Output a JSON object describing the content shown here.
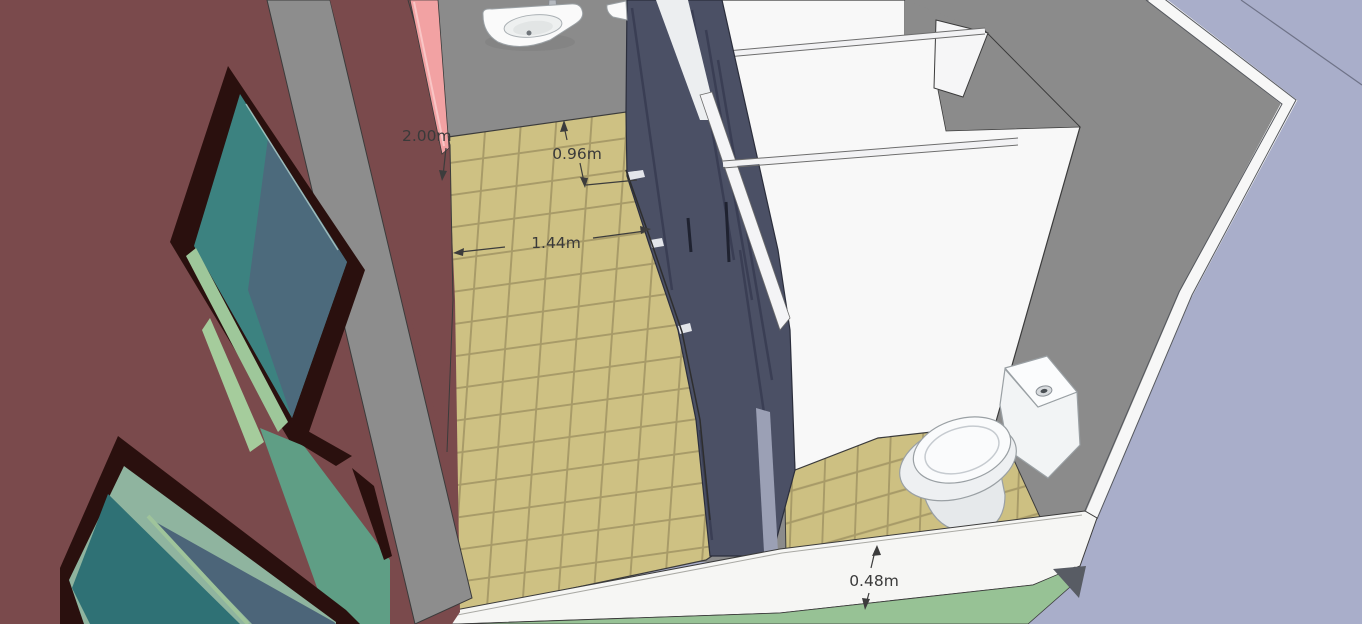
{
  "scene": {
    "type": "3d-model-viewport",
    "description": "SketchUp-style 3D cutaway model of a public restroom: tiled corridor, three dark toilet-stall doors with white partitions, two wall-hung sinks, one toilet, maroon exterior wall with windows, lavender exterior wall, dimension annotations"
  },
  "dims": {
    "wall_height": "2.00m",
    "stall_depth": "0.96m",
    "corridor_width": "1.44m",
    "wall_base": "0.48m"
  },
  "objects": {
    "left_wall": "maroon exterior wall",
    "window_upper": "upper window (teal glass, dark brown frame)",
    "window_lower": "lower window (teal glass, dark brown frame)",
    "section_cut": "pink section-cut face of front wall",
    "back_wall": "gray interior back wall",
    "sink_left": "wall-hung sink with faucet",
    "sink_right": "second sink (partially visible)",
    "stall_doors": "dark blue-gray stall doors",
    "partitions": "white stall partitions",
    "toilet": "white toilet with tank and flush button",
    "corridor_floor": "tan ceramic tile floor",
    "stall_floor": "tan ceramic tile floor in toilet stall",
    "bottom_wall_cut": "white cut face of front wall (0.48m thick)",
    "ground": "green ground outside",
    "right_wall": "lavender exterior wall"
  },
  "palette": {
    "maroon": "#7a4a4c",
    "gray_wall": "#8b8b8b",
    "pink_cut": "#f2a2a3",
    "tile": "#cec183",
    "grout": "#a89b68",
    "stall_dark": "#4b5065",
    "partition_white": "#f8f8f8",
    "lavender": "#a9aeca",
    "ground_green": "#97c295",
    "glass_teal": "#3c8280",
    "glass_blue": "#4c6a7c",
    "glass_sage": "#9ec79a",
    "trim_green": "#5f9e85",
    "frame_brown": "#2a100e",
    "dim_text": "#3a3a3a"
  }
}
